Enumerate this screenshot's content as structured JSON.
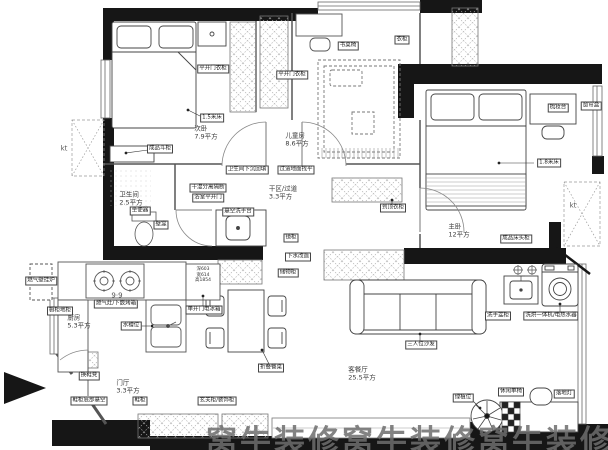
{
  "watermark": "窝牛装修窝牛装修窝牛装修",
  "rooms": [
    {
      "id": "ciwo",
      "name": "次卧",
      "area": "7.9平方",
      "x": 206,
      "y": 133
    },
    {
      "id": "ertongfang",
      "name": "儿童房",
      "area": "8.6平方",
      "x": 297,
      "y": 140
    },
    {
      "id": "weishengjian",
      "name": "卫生间",
      "area": "2.5平方",
      "x": 131,
      "y": 199
    },
    {
      "id": "ganqu",
      "name": "干区/过道",
      "area": "3.3平方",
      "x": 283,
      "y": 193
    },
    {
      "id": "zhuwo",
      "name": "主卧",
      "area": "12平方",
      "x": 459,
      "y": 231
    },
    {
      "id": "chufang",
      "name": "厨房",
      "area": "5.3平方",
      "x": 79,
      "y": 322
    },
    {
      "id": "menting",
      "name": "门厅",
      "area": "3.3平方",
      "x": 128,
      "y": 387
    },
    {
      "id": "keting",
      "name": "客餐厅",
      "area": "25.5平方",
      "x": 362,
      "y": 374
    }
  ],
  "tags": [
    {
      "id": "wardrobe-left",
      "text": "平开门衣柜",
      "x": 213,
      "y": 69
    },
    {
      "id": "wardrobe-right",
      "text": "平开门衣柜",
      "x": 292,
      "y": 75
    },
    {
      "id": "kids-desk",
      "text": "书桌椅",
      "x": 348,
      "y": 46
    },
    {
      "id": "kids-wardrobe",
      "text": "衣柜",
      "x": 402,
      "y": 40
    },
    {
      "id": "bed-15",
      "text": "1.5米床",
      "x": 212,
      "y": 118
    },
    {
      "id": "dresser",
      "text": "成品斗柜",
      "x": 160,
      "y": 149
    },
    {
      "id": "toilet-tag",
      "text": "坐便器",
      "x": 140,
      "y": 211
    },
    {
      "id": "niche",
      "text": "壁龛",
      "x": 161,
      "y": 225
    },
    {
      "id": "shower-partition",
      "text": "干湿分离隔断",
      "x": 208,
      "y": 188
    },
    {
      "id": "bath-door",
      "text": "浴室平开门",
      "x": 208,
      "y": 198
    },
    {
      "id": "backfill-left",
      "text": "卫生间下沉回填",
      "x": 247,
      "y": 170
    },
    {
      "id": "backfill-right",
      "text": "过道地面找平",
      "x": 296,
      "y": 170
    },
    {
      "id": "vanity-tag",
      "text": "悬空洗手台",
      "x": 238,
      "y": 212
    },
    {
      "id": "mirror",
      "text": "镜柜",
      "x": 291,
      "y": 238
    },
    {
      "id": "drain-tag",
      "text": "下水改造",
      "x": 298,
      "y": 257
    },
    {
      "id": "hall-cabinet",
      "text": "储物柜",
      "x": 288,
      "y": 273
    },
    {
      "id": "kids-closet",
      "text": "到顶衣柜",
      "x": 393,
      "y": 208
    },
    {
      "id": "curtain-box",
      "text": "窗帘盒",
      "x": 591,
      "y": 106
    },
    {
      "id": "master-desk",
      "text": "梳妆台",
      "x": 558,
      "y": 108
    },
    {
      "id": "bed-18",
      "text": "1.8米床",
      "x": 549,
      "y": 163
    },
    {
      "id": "nightstand",
      "text": "成品床头柜",
      "x": 516,
      "y": 239
    },
    {
      "id": "basin-tag",
      "text": "洗手盆柜",
      "x": 498,
      "y": 316
    },
    {
      "id": "washer-tag",
      "text": "洗烘一体机/电热水器",
      "x": 551,
      "y": 316
    },
    {
      "id": "sofa-tag",
      "text": "三人位沙发",
      "x": 421,
      "y": 345
    },
    {
      "id": "plant-tag",
      "text": "绿植位",
      "x": 463,
      "y": 398
    },
    {
      "id": "chair-tag",
      "text": "休闲单椅",
      "x": 511,
      "y": 392
    },
    {
      "id": "floor-lamp",
      "text": "落地灯",
      "x": 564,
      "y": 394
    },
    {
      "id": "dining-tag",
      "text": "折叠餐桌",
      "x": 271,
      "y": 368
    },
    {
      "id": "stove-tag",
      "text": "燃气灶/下嵌烤箱",
      "x": 116,
      "y": 304
    },
    {
      "id": "base-cabinet",
      "text": "橱柜地柜",
      "x": 60,
      "y": 311
    },
    {
      "id": "boiler-tag",
      "text": "燃气壁挂炉",
      "x": 41,
      "y": 281
    },
    {
      "id": "sink-tag",
      "text": "水槽位",
      "x": 131,
      "y": 326
    },
    {
      "id": "fridge-tag",
      "text": "单开门电冰箱",
      "x": 204,
      "y": 310
    },
    {
      "id": "bench-tag",
      "text": "换鞋凳",
      "x": 89,
      "y": 376
    },
    {
      "id": "shoe-cab",
      "text": "鞋柜底部悬空",
      "x": 89,
      "y": 401
    },
    {
      "id": "shoe-cab2",
      "text": "鞋柜",
      "x": 140,
      "y": 401
    },
    {
      "id": "entry-cab",
      "text": "玄关柜/装饰柜",
      "x": 217,
      "y": 401
    },
    {
      "id": "kt-left",
      "text": "kt",
      "x": 64,
      "y": 149,
      "plain": true
    },
    {
      "id": "kt-right",
      "text": "kt",
      "x": 573,
      "y": 206,
      "plain": true
    },
    {
      "id": "stove-dim",
      "text": "9·9",
      "x": 117,
      "y": 296,
      "plain": true
    }
  ],
  "fridge": {
    "line1": "深603",
    "line2": "宽614",
    "line3": "高1854"
  }
}
